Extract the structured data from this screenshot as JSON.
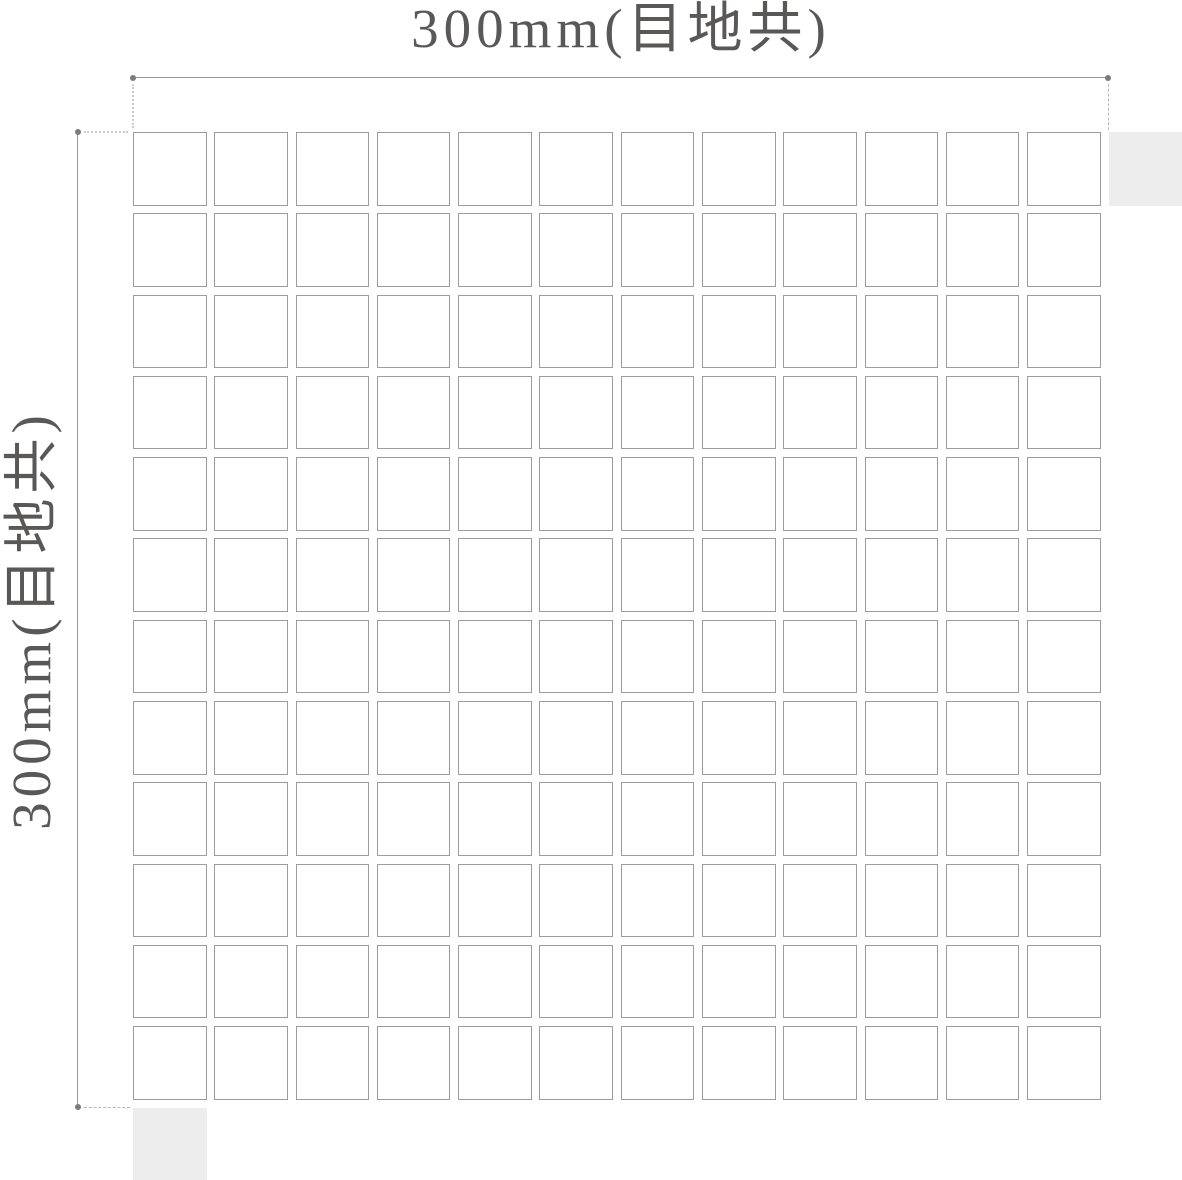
{
  "diagram": {
    "horizontal_dimension_label": "300mm(目地共)",
    "vertical_dimension_label": "300mm(目地共)",
    "grid": {
      "rows": 12,
      "columns": 12
    },
    "ghost_tiles": [
      "top-right",
      "bottom-left"
    ],
    "colors": {
      "background": "#ffffff",
      "label_text": "#5a5757",
      "dimension_line": "#9b9b9b",
      "dimension_dot": "#7b7b7b",
      "extension_dotted": "#cccccc",
      "extension_dashed": "#b8b8b8",
      "tile_border": "#9c9c9c",
      "tile_fill": "#ffffff",
      "ghost_tile_fill": "#ededed"
    }
  }
}
